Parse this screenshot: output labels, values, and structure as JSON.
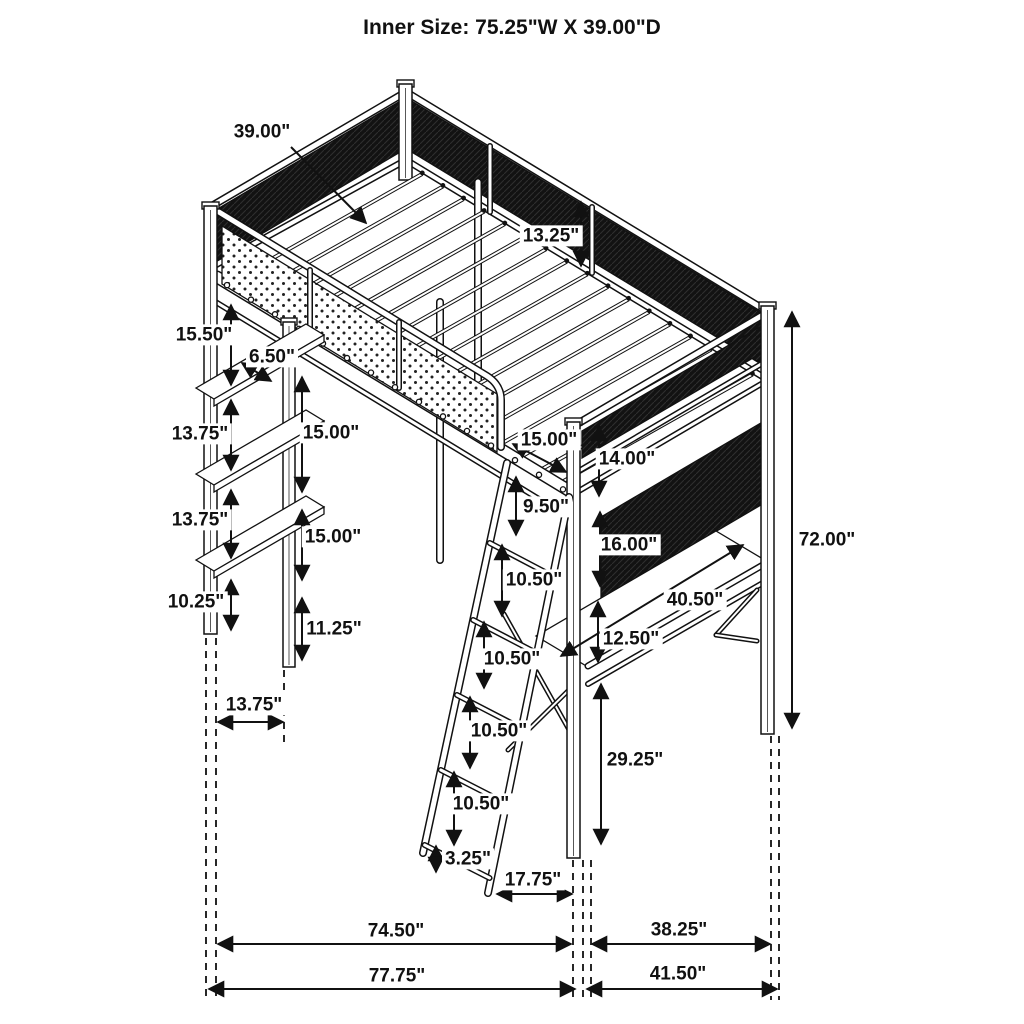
{
  "title": "Inner Size: 75.25\"W X 39.00\"D",
  "diagram": {
    "subject": "Metal loft bed with guardrails, storage shelves, side desk and angled ladder — dimension drawing",
    "units": "inches",
    "inner_width": "75.25\"",
    "inner_depth": "39.00\"",
    "line_color": "#111111",
    "mesh_color": "#121212"
  },
  "dimensions": [
    {
      "id": "bed_depth",
      "label": "39.00\""
    },
    {
      "id": "guardrail_height",
      "label": "13.25\""
    },
    {
      "id": "top_shelf_gap",
      "label": "15.50\""
    },
    {
      "id": "shelf_depth",
      "label": "6.50\""
    },
    {
      "id": "shelf_gap_1",
      "label": "13.75\""
    },
    {
      "id": "shelf_spacing_1",
      "label": "15.00\""
    },
    {
      "id": "shelf_gap_2",
      "label": "13.75\""
    },
    {
      "id": "shelf_spacing_2",
      "label": "15.00\""
    },
    {
      "id": "bottom_shelf_height",
      "label": "10.25\""
    },
    {
      "id": "shelf_post_foot",
      "label": "11.25\""
    },
    {
      "id": "shelf_unit_depth",
      "label": "13.75\""
    },
    {
      "id": "ladder_opening",
      "label": "15.00\""
    },
    {
      "id": "ladder_top_spacing",
      "label": "9.50\""
    },
    {
      "id": "end_panel_gap",
      "label": "14.00\""
    },
    {
      "id": "end_mesh_height",
      "label": "16.00\""
    },
    {
      "id": "rung_spacing_1",
      "label": "10.50\""
    },
    {
      "id": "rung_spacing_2",
      "label": "10.50\""
    },
    {
      "id": "rung_spacing_3",
      "label": "10.50\""
    },
    {
      "id": "rung_spacing_4",
      "label": "10.50\""
    },
    {
      "id": "desk_length",
      "label": "40.50\""
    },
    {
      "id": "desk_drop",
      "label": "12.50\""
    },
    {
      "id": "desk_clearance",
      "label": "29.25\""
    },
    {
      "id": "overall_height",
      "label": "72.00\""
    },
    {
      "id": "ladder_bottom_gap",
      "label": "3.25\""
    },
    {
      "id": "ladder_foot_offset",
      "label": "17.75\""
    },
    {
      "id": "frame_span",
      "label": "74.50\""
    },
    {
      "id": "desk_end_span",
      "label": "38.25\""
    },
    {
      "id": "overall_length",
      "label": "77.75\""
    },
    {
      "id": "overall_end_span",
      "label": "41.50\""
    }
  ]
}
